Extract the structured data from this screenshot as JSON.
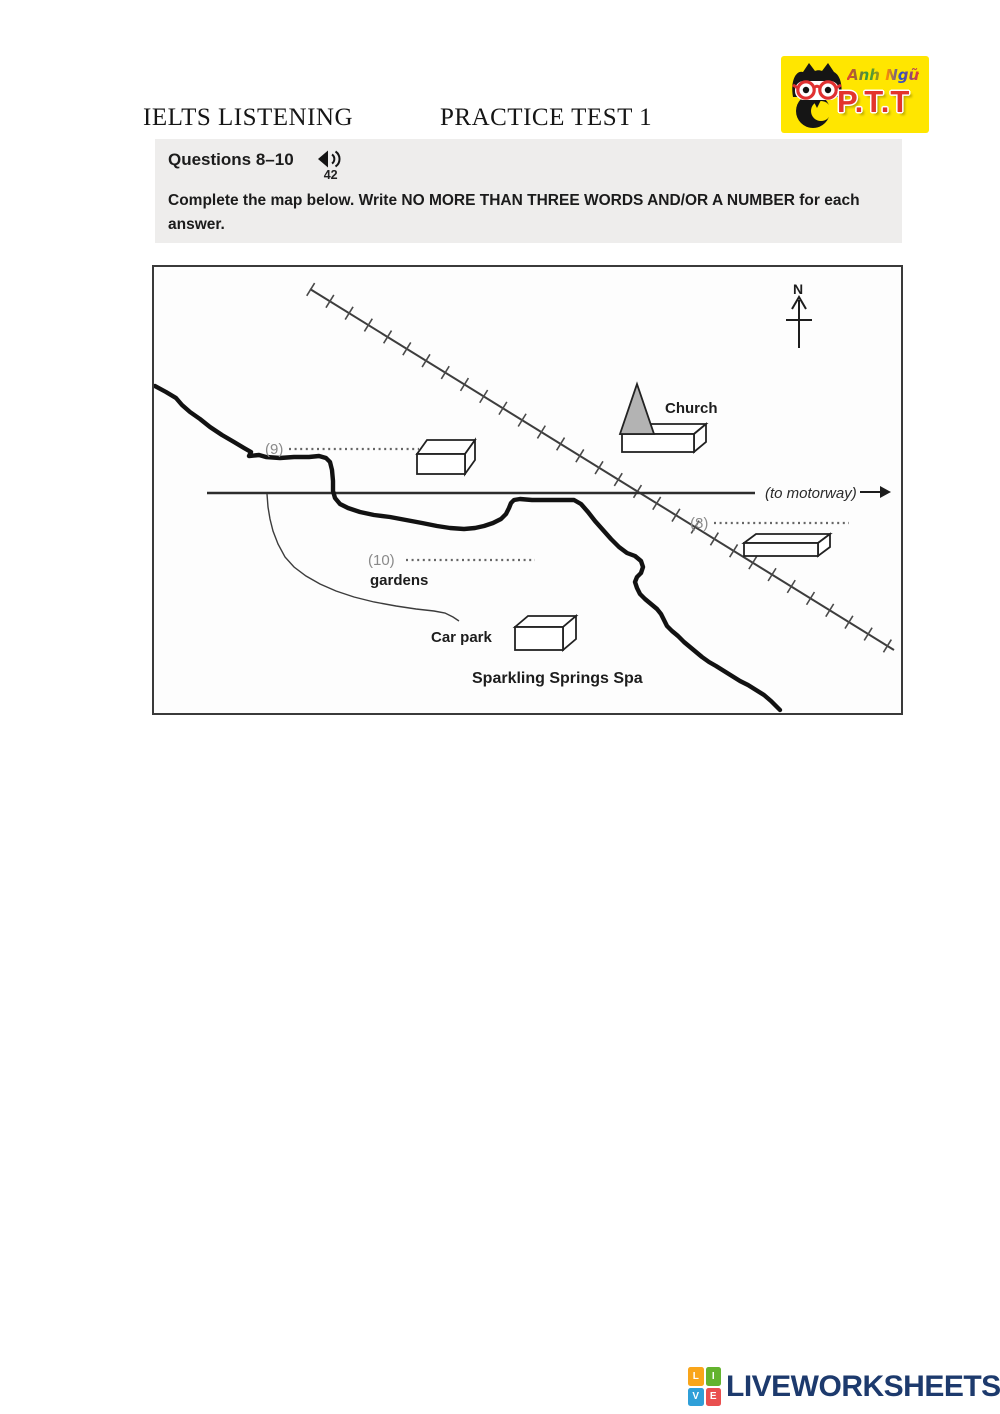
{
  "page": {
    "title_left": "IELTS LISTENING",
    "title_right": "PRACTICE TEST 1"
  },
  "logo": {
    "brand_script": "Anh Ngữ",
    "brand_name": "P.T.T",
    "bg_color": "#ffe600",
    "accent_red": "#e3342c"
  },
  "question_box": {
    "heading": "Questions 8–10",
    "audio_number": "42",
    "instruction_pre": "Complete the map below. Write ",
    "instruction_bold": "NO MORE THAN THREE WORDS AND/OR A NUMBER",
    "instruction_post": " for each answer.",
    "bg_color": "#eeedec"
  },
  "map": {
    "north_label": "N",
    "church_label": "Church",
    "motorway_label": "(to motorway)",
    "q9_label": "(9)",
    "q8_label": "(8)",
    "q10_label": "(10)",
    "gardens_label": "gardens",
    "car_park_label": "Car park",
    "spa_label": "Sparkling Springs Spa",
    "spire_fill": "#b3b3b3"
  },
  "footer": {
    "brand": "LIVEWORKSHEETS",
    "brand_color": "#1d3a6d",
    "icon_letters": [
      "L",
      "I",
      "V",
      "E"
    ],
    "icon_colors": [
      "#f9a51a",
      "#63b32e",
      "#2f9fd8",
      "#e94f4f"
    ]
  }
}
